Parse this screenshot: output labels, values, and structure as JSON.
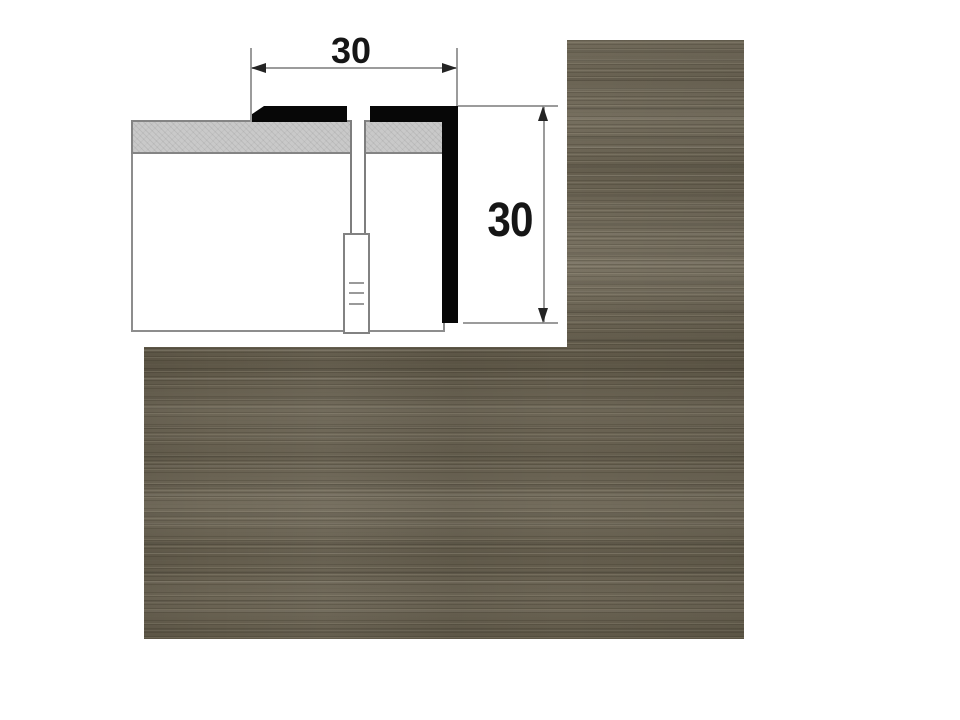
{
  "product_image": {
    "diagram": {
      "width_dimension_label": "30",
      "height_dimension_label": "30"
    },
    "colors": {
      "wood_finish_base": "#6c6555",
      "wood_finish_dark_streak": "#57503f",
      "wood_finish_light_streak": "#8c8674",
      "profile_black": "#070707",
      "screed_grey": "#c9c9c9",
      "dimension_line_grey": "#9b9b9b",
      "dimension_text": "#161616",
      "background": "#ffffff"
    }
  }
}
